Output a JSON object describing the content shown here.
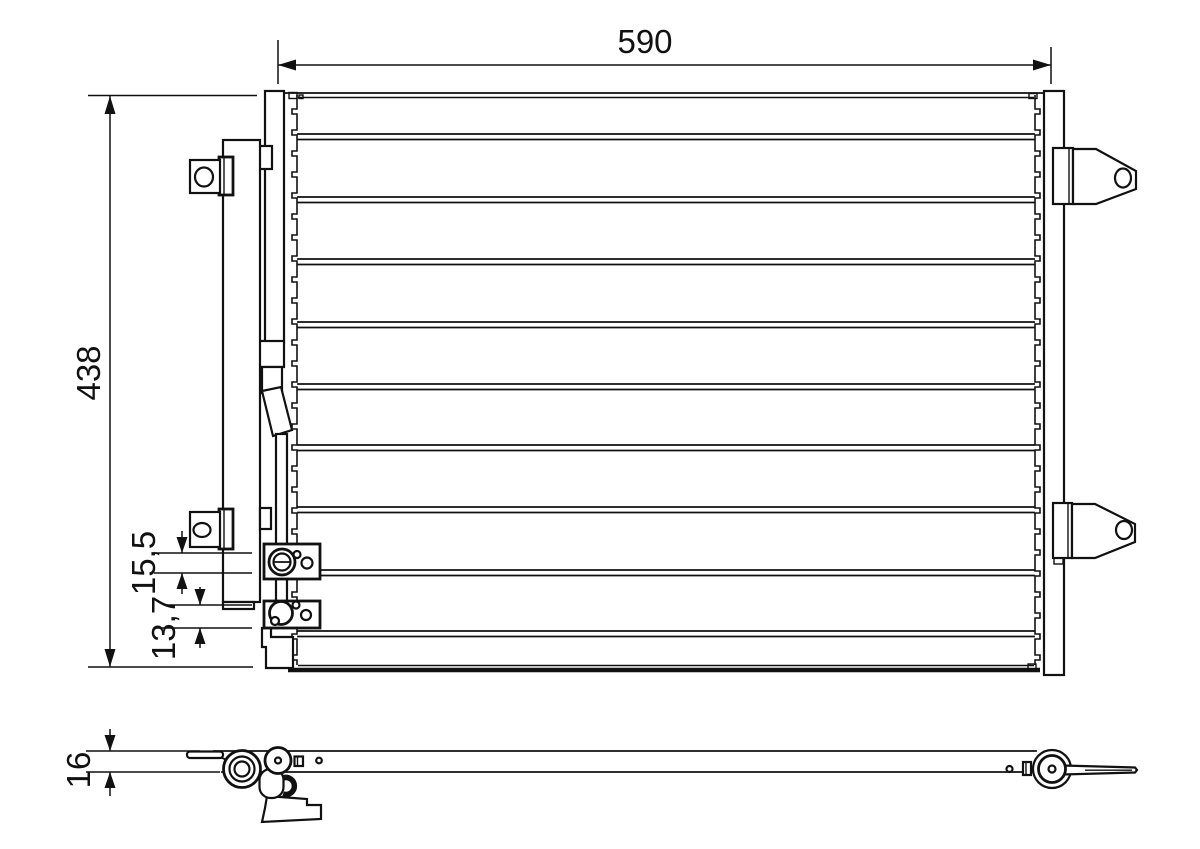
{
  "page": {
    "background": "#ffffff",
    "line_color": "#111111",
    "description_labels_visible": [
      "590",
      "438",
      "15,5",
      "13,7",
      "16"
    ]
  },
  "dimensions": {
    "width": "590",
    "height": "438",
    "upper_port_offset": "15,5",
    "lower_port_offset": "13,7",
    "depth": "16"
  }
}
